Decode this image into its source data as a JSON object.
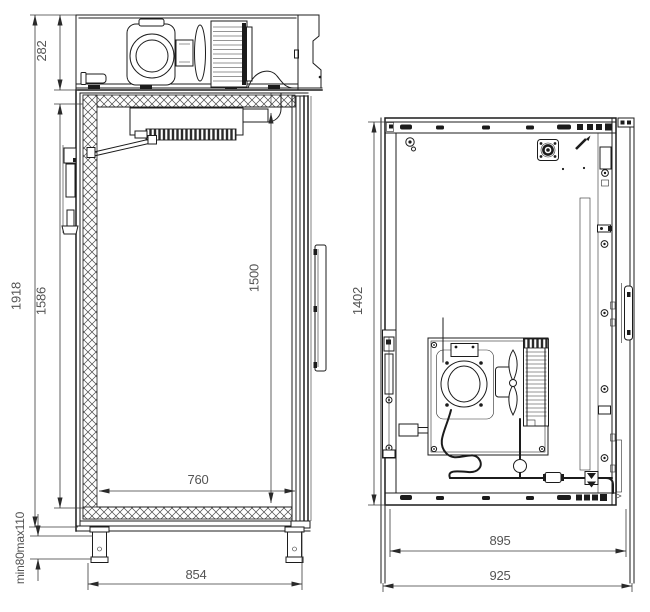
{
  "drawing": {
    "side_view": {
      "unit_height": "282",
      "overall_height": "1918",
      "interior_rear_height": "1586",
      "interior_front_height": "1500",
      "interior_depth": "760",
      "overall_depth": "854",
      "leg_height": "min80max110"
    },
    "rear_view": {
      "panel_height": "1402",
      "body_width": "895",
      "overall_width": "925"
    },
    "colors": {
      "line": "#1c1c1c",
      "dim_line": "#3a3a3a",
      "dim_text": "#545454",
      "background": "#ffffff"
    }
  }
}
